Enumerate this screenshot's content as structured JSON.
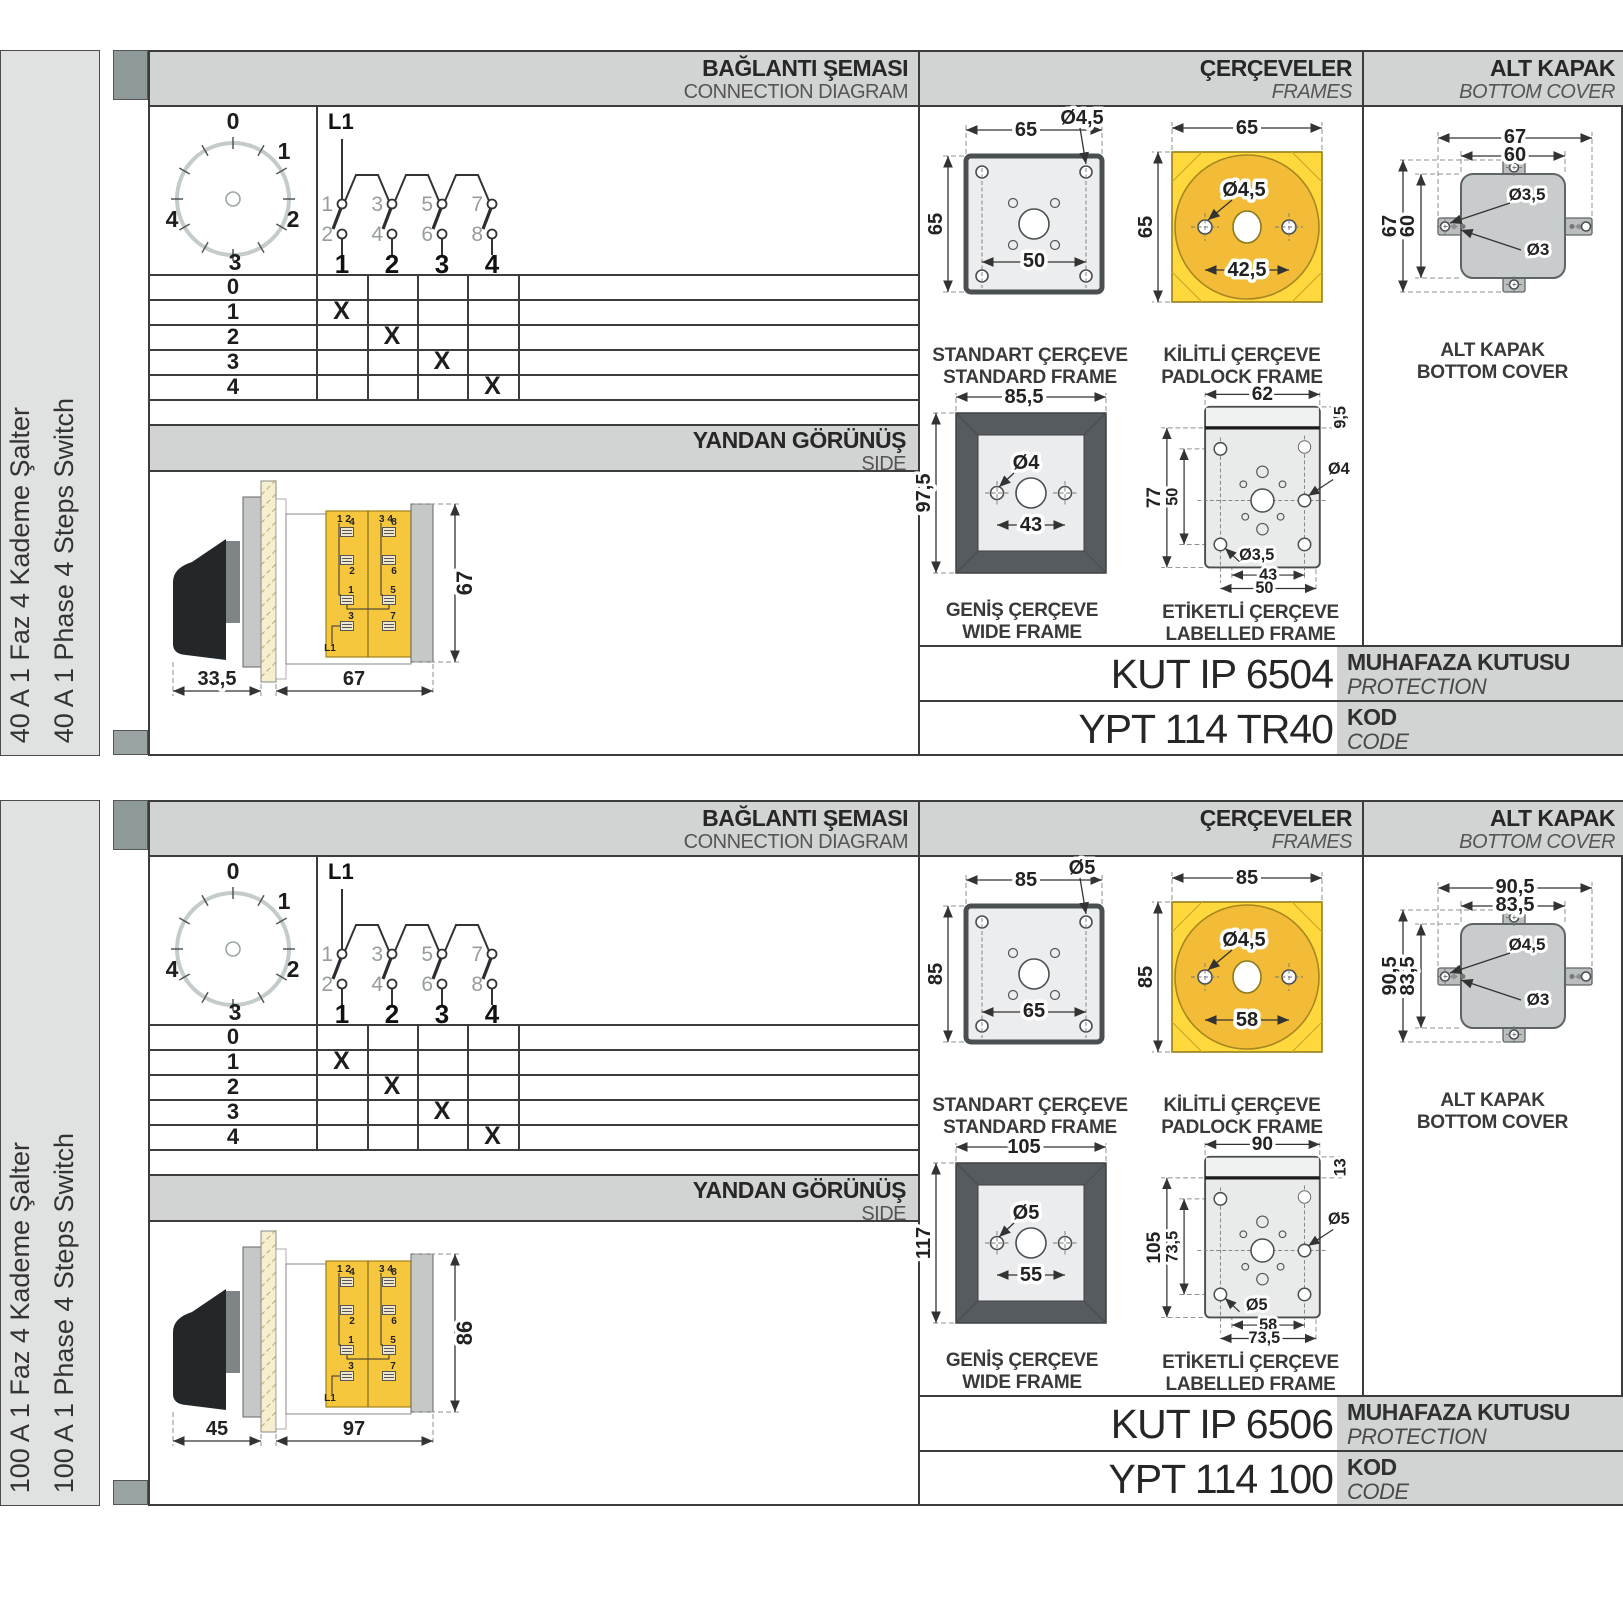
{
  "colors": {
    "band_grey": "#d2d4d4",
    "bar_grey": "#e0e1e1",
    "tab_grey": "#8e9a9a",
    "yellow_frame": "#ffd83d",
    "yellow_circle": "#f2bc38",
    "yellow_block": "#f6c63c",
    "frame_dark": "#565b5f",
    "cover_grey": "#c9cccc",
    "line_dark": "#3c3c3c"
  },
  "sections": [
    {
      "product_tr": "40 A 1 Faz 4 Kademe Şalter",
      "product_en": "40 A 1 Phase 4 Steps Switch",
      "headers": {
        "diagram_tr": "BAĞLANTI ŞEMASI",
        "diagram_en": "CONNECTION DIAGRAM",
        "frames_tr": "ÇERÇEVELER",
        "frames_en": "FRAMES",
        "cover_tr": "ALT KAPAK",
        "cover_en": "BOTTOM COVER"
      },
      "dial": {
        "p": [
          "0",
          "1",
          "2",
          "3",
          "4"
        ]
      },
      "circuit": {
        "feed": "L1",
        "top": [
          "1",
          "3",
          "5",
          "7"
        ],
        "bot": [
          "2",
          "4",
          "6",
          "8"
        ],
        "out": [
          "1",
          "2",
          "3",
          "4"
        ]
      },
      "table": {
        "rows": [
          {
            "label": "0",
            "c": [
              "",
              "",
              "",
              ""
            ]
          },
          {
            "label": "1",
            "c": [
              "X",
              "",
              "",
              ""
            ]
          },
          {
            "label": "2",
            "c": [
              "",
              "X",
              "",
              ""
            ]
          },
          {
            "label": "3",
            "c": [
              "",
              "",
              "X",
              ""
            ]
          },
          {
            "label": "4",
            "c": [
              "",
              "",
              "",
              "X"
            ]
          }
        ]
      },
      "side": {
        "title_tr": "YANDAN GÖRÜNÜŞ",
        "title_en": "SIDE",
        "dim_a": "33,5",
        "dim_b": "67",
        "dim_h": "67",
        "lbl_lt": "1 2",
        "lbl_rt": "3 4",
        "t_l": [
          "4",
          "2",
          "1",
          "3"
        ],
        "t_r": [
          "8",
          "6",
          "5",
          "7"
        ],
        "feed": "L1"
      },
      "standard": {
        "title_tr": "STANDART ÇERÇEVE",
        "title_en": "STANDARD FRAME",
        "w": "65",
        "h": "65",
        "hole": "Ø4,5",
        "pitch": "50"
      },
      "padlock": {
        "title_tr": "KİLİTLİ ÇERÇEVE",
        "title_en": "PADLOCK FRAME",
        "w": "65",
        "h": "65",
        "hole": "Ø4,5",
        "pitch": "42,5"
      },
      "wide": {
        "title_tr": "GENİŞ ÇERÇEVE",
        "title_en": "WIDE FRAME",
        "w": "85,5",
        "h": "97,5",
        "hole": "Ø4",
        "pitch": "43"
      },
      "labelled": {
        "title_tr": "ETİKETLİ ÇERÇEVE",
        "title_en": "LABELLED FRAME",
        "w": "62",
        "top": "9,5",
        "h_outer": "77",
        "h_inner": "50",
        "hole_r": "Ø4",
        "hole_bl": "Ø3,5",
        "pitch_a": "43",
        "pitch_b": "50"
      },
      "cover": {
        "title_tr": "ALT KAPAK",
        "title_en": "BOTTOM COVER",
        "w_outer": "67",
        "w_inner": "60",
        "h_outer": "67",
        "h_inner": "60",
        "hole_a": "Ø3,5",
        "hole_b": "Ø3"
      },
      "codes": {
        "enclosure": "KUT IP 6504",
        "enclosure_tr": "MUHAFAZA KUTUSU",
        "enclosure_en": "PROTECTION ENCLOSURE",
        "code": "YPT 114 TR40",
        "code_tr": "KOD",
        "code_en": "CODE"
      }
    },
    {
      "product_tr": "100 A 1 Faz 4 Kademe Şalter",
      "product_en": "100 A 1 Phase 4 Steps Switch",
      "headers": {
        "diagram_tr": "BAĞLANTI ŞEMASI",
        "diagram_en": "CONNECTION DIAGRAM",
        "frames_tr": "ÇERÇEVELER",
        "frames_en": "FRAMES",
        "cover_tr": "ALT KAPAK",
        "cover_en": "BOTTOM COVER"
      },
      "dial": {
        "p": [
          "0",
          "1",
          "2",
          "3",
          "4"
        ]
      },
      "circuit": {
        "feed": "L1",
        "top": [
          "1",
          "3",
          "5",
          "7"
        ],
        "bot": [
          "2",
          "4",
          "6",
          "8"
        ],
        "out": [
          "1",
          "2",
          "3",
          "4"
        ]
      },
      "table": {
        "rows": [
          {
            "label": "0",
            "c": [
              "",
              "",
              "",
              ""
            ]
          },
          {
            "label": "1",
            "c": [
              "X",
              "",
              "",
              ""
            ]
          },
          {
            "label": "2",
            "c": [
              "",
              "X",
              "",
              ""
            ]
          },
          {
            "label": "3",
            "c": [
              "",
              "",
              "X",
              ""
            ]
          },
          {
            "label": "4",
            "c": [
              "",
              "",
              "",
              "X"
            ]
          }
        ]
      },
      "side": {
        "title_tr": "YANDAN GÖRÜNÜŞ",
        "title_en": "SIDE",
        "dim_a": "45",
        "dim_b": "97",
        "dim_h": "86",
        "lbl_lt": "1 2",
        "lbl_rt": "3 4",
        "t_l": [
          "4",
          "2",
          "1",
          "3"
        ],
        "t_r": [
          "8",
          "6",
          "5",
          "7"
        ],
        "feed": "L1"
      },
      "standard": {
        "title_tr": "STANDART ÇERÇEVE",
        "title_en": "STANDARD FRAME",
        "w": "85",
        "h": "85",
        "hole": "Ø5",
        "pitch": "65"
      },
      "padlock": {
        "title_tr": "KİLİTLİ ÇERÇEVE",
        "title_en": "PADLOCK FRAME",
        "w": "85",
        "h": "85",
        "hole": "Ø4,5",
        "pitch": "58"
      },
      "wide": {
        "title_tr": "GENİŞ ÇERÇEVE",
        "title_en": "WIDE FRAME",
        "w": "105",
        "h": "117",
        "hole": "Ø5",
        "pitch": "55"
      },
      "labelled": {
        "title_tr": "ETİKETLİ ÇERÇEVE",
        "title_en": "LABELLED FRAME",
        "w": "90",
        "top": "13",
        "h_outer": "105",
        "h_inner": "73,5",
        "hole_r": "Ø5",
        "hole_bl": "Ø5",
        "pitch_a": "58",
        "pitch_b": "73,5"
      },
      "cover": {
        "title_tr": "ALT KAPAK",
        "title_en": "BOTTOM COVER",
        "w_outer": "90,5",
        "w_inner": "83,5",
        "h_outer": "90,5",
        "h_inner": "83,5",
        "hole_a": "Ø4,5",
        "hole_b": "Ø3"
      },
      "codes": {
        "enclosure": "KUT IP 6506",
        "enclosure_tr": "MUHAFAZA KUTUSU",
        "enclosure_en": "PROTECTION ENCLOSURE",
        "code": "YPT 114 100",
        "code_tr": "KOD",
        "code_en": "CODE"
      }
    }
  ]
}
